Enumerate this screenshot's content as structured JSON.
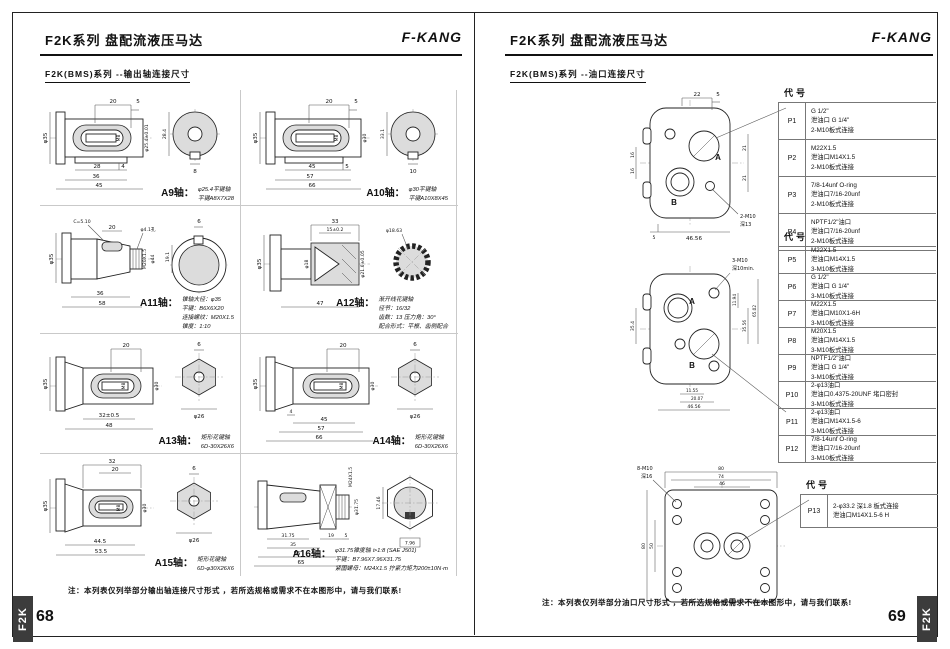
{
  "page_left": {
    "title": "F2K系列 盘配流液压马达",
    "brand": "F-KANG",
    "subtitle": "F2K(BMS)系列 --输出轴连接尺寸",
    "note": "注：本列表仅列举部分输出轴连接尺寸形式 ，若所选规格或需求不在本图形中，请与我们联系!",
    "page_number": "68",
    "side_tab": "F2K",
    "shafts": [
      {
        "name": "A9轴：",
        "desc": [
          "φ25.4平键轴",
          "平键A8X7X28"
        ],
        "dims": [
          "20",
          "5",
          "φ35",
          "M8",
          "φ25.4±0.01",
          "28",
          "4",
          "36",
          "45",
          "28.4",
          "8"
        ]
      },
      {
        "name": "A10轴：",
        "desc": [
          "φ30平键轴",
          "平键A10X8X45"
        ],
        "dims": [
          "20",
          "5",
          "φ35",
          "M8",
          "φ30",
          "45",
          "5",
          "57",
          "66",
          "33.1",
          "10"
        ]
      },
      {
        "name": "A11轴：",
        "desc": [
          "锥轴大径：φ35",
          "平键：B6X6X20",
          "连接螺纹：M20X1.5",
          "锥度：1:10"
        ],
        "dims": [
          "C=5.10",
          "20",
          "φ4.1孔",
          "φ35",
          "M20X1.5",
          "φ44",
          "36",
          "58",
          "6",
          "19.1"
        ]
      },
      {
        "name": "A12轴：",
        "desc": [
          "渐开线花键轴",
          "径节：16/32",
          "齿数：13 压力角：30°",
          "配合形式：平根、齿侧配合"
        ],
        "dims": [
          "33",
          "15±0.2",
          "φ35",
          "φ18",
          "φ21.6±0.05",
          "47",
          "φ18.63"
        ]
      },
      {
        "name": "A13轴：",
        "desc": [
          "矩形花键轴",
          "6D-30X26X6"
        ],
        "dims": [
          "20",
          "φ35",
          "M8",
          "φ30",
          "32±0.5",
          "48",
          "6",
          "φ26"
        ]
      },
      {
        "name": "A14轴：",
        "desc": [
          "矩形花键轴",
          "6D-30X26X6"
        ],
        "dims": [
          "20",
          "φ35",
          "M8",
          "φ30",
          "4",
          "45",
          "57",
          "66",
          "6",
          "φ26"
        ]
      },
      {
        "name": "A15轴：",
        "desc": [
          "矩形花键轴",
          "6D-φ30X26X6"
        ],
        "dims": [
          "32",
          "20",
          "φ35",
          "M8",
          "φ30",
          "44.5",
          "53.5",
          "6",
          "φ26"
        ]
      },
      {
        "name": "A16轴：",
        "desc": [
          "φ31.75锥度轴 ⊳1:8  (SAE J501)",
          "平键：B7.96X7.96X31.75",
          "紧固螺母：M24X1.5 拧紧力矩为200±10N·m"
        ],
        "dims": [
          "M24X1.5",
          "φ31.75",
          "31.75",
          "35",
          "19",
          "5",
          "55",
          "65",
          "17.46",
          "7.96"
        ]
      }
    ]
  },
  "page_right": {
    "title": "F2K系列 盘配流液压马达",
    "brand": "F-KANG",
    "subtitle": "F2K(BMS)系列 --油口连接尺寸",
    "note": "注：本列表仅列举部分油口尺寸形式 ，若所选规格或需求不在本图形中，请与我们联系!",
    "page_number": "69",
    "side_tab": "F2K",
    "diagram1": {
      "port_a": "A",
      "port_b": "B",
      "callout": [
        "2-M10",
        "深13"
      ],
      "dims": [
        "22",
        "5",
        "16",
        "16",
        "21",
        "21",
        "5",
        "46.56"
      ]
    },
    "diagram2": {
      "port_a": "A",
      "port_b": "B",
      "callout": [
        "3-M10",
        "深10min."
      ],
      "dims": [
        "35.4",
        "11.94",
        "35.56",
        "65.02",
        "11.55",
        "20.07",
        "46.56"
      ]
    },
    "diagram3": {
      "callout": [
        "8-M10",
        "深16"
      ],
      "dims": [
        "80",
        "74",
        "46",
        "80",
        "50"
      ]
    },
    "table1": {
      "header": "代号",
      "rows": [
        {
          "code": "P1",
          "lines": [
            "G 1/2\"",
            "泄油口 G 1/4\"",
            "2-M10板式连接"
          ]
        },
        {
          "code": "P2",
          "lines": [
            "M22X1.5",
            "泄油口M14X1.5",
            "2-M10板式连接"
          ]
        },
        {
          "code": "P3",
          "lines": [
            "7/8-14unf O-ring",
            "泄油口7/16-20unf",
            "2-M10板式连接"
          ]
        },
        {
          "code": "P4",
          "lines": [
            "NPTF1/2\"油口",
            "泄油口7/16-20unf",
            "2-M10板式连接"
          ]
        }
      ]
    },
    "table2": {
      "header": "代号",
      "rows": [
        {
          "code": "P5",
          "lines": [
            "M22X1.5",
            "泄油口M14X1.5",
            "3-M10板式连接"
          ]
        },
        {
          "code": "P6",
          "lines": [
            "G 1/2\"",
            "泄油口 G 1/4\"",
            "3-M10板式连接"
          ]
        },
        {
          "code": "P7",
          "lines": [
            "M22X1.5",
            "泄油口M10X1-6H",
            "3-M10板式连接"
          ]
        },
        {
          "code": "P8",
          "lines": [
            "M20X1.5",
            "泄油口M14X1.5",
            "3-M10板式连接"
          ]
        },
        {
          "code": "P9",
          "lines": [
            "NPTF1/2\"油口",
            "泄油口 G 1/4\"",
            "3-M10板式连接"
          ]
        },
        {
          "code": "P10",
          "lines": [
            "2-φ13油口",
            "泄油口0.4375-20UNF 堵口密封",
            "3-M10板式连接"
          ]
        },
        {
          "code": "P11",
          "lines": [
            "2-φ13油口",
            "泄油口M14X1.5-6",
            "3-M10板式连接"
          ]
        },
        {
          "code": "P12",
          "lines": [
            "7/8-14unf O-ring",
            "泄油口7/16-20unf",
            "3-M10板式连接"
          ]
        }
      ]
    },
    "table3": {
      "header": "代号",
      "rows": [
        {
          "code": "P13",
          "lines": [
            "2-φ33.2 深1.8 板式连接",
            "泄油口M14X1.5-6 H"
          ]
        }
      ]
    }
  }
}
